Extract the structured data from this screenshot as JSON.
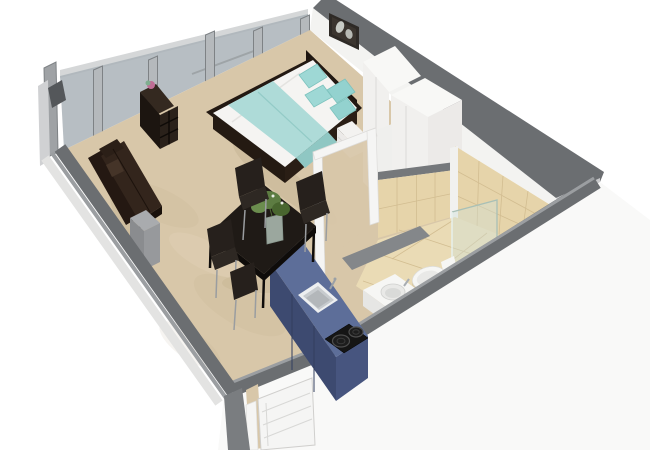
{
  "scene": {
    "type": "3d-floorplan-rendering",
    "room": "studio-apartment",
    "background": "#ffffff"
  },
  "colors": {
    "bg": "#ffffff",
    "carpet": "#d8c7a9",
    "carpetShade": "#bcab8c",
    "carpetLight": "#e6d8bd",
    "tileWall": "#e6d4aa",
    "tileFloor": "#eadbb5",
    "tileGrout": "#d2bd91",
    "glass": "#aab3b8",
    "pillar": "#b5b9bc",
    "pillarEdge": "#7e8285",
    "wallWhite": "#f3f3f1",
    "wallCap": "#6b6e71",
    "wallCapLight": "#9b9ea1",
    "wallOuterLight": "#c8c9cb",
    "outerFace": "#f9f9f8",
    "partitionCap": "#75787b",
    "halfWall": "#84878a",
    "bedFrame": "#231912",
    "headboard": "#1d1510",
    "mattress": "#f5f4f2",
    "blanket": "#aedbd8",
    "blanketFold": "#8fc7c3",
    "pillowA": "#9ed8d5",
    "pillowB": "#93d2cf",
    "wardrobeFront": "#f1f0ee",
    "wardrobeSide": "#eceae8",
    "wardrobeTop": "#f8f8f6",
    "nightstand": "#f3f2f0",
    "pictureFrame": "#2e2a26",
    "pictureArt": "#d8dcd6",
    "shelfDark": "#1c1510",
    "shelfSide": "#2a211a",
    "shelfTop": "#342920",
    "decorBall": "#c06d95",
    "decorLeaf": "#7fae8f",
    "sofa": "#241812",
    "sofaSeat": "#33251c",
    "pedestal": "#a9abae",
    "pedestalFront": "#8a8c8f",
    "tableTop": "#1f1a16",
    "tableEdge": "#0f0c0a",
    "chair": "#26201c",
    "chairSeat": "#2e2823",
    "metalLeg": "#9a9da0",
    "plantGreen": "#5d7c42",
    "plantDark": "#49662f",
    "plantLight": "#6b8d4e",
    "vase": "#c5d6cc",
    "counterTop": "#5d6e99",
    "counterFront": "#3d4a70",
    "counterSide": "#47557f",
    "sinkRim": "#edeff0",
    "sinkBasin": "#c7cbce",
    "cooktop": "#151515",
    "burnerRing": "#4d4d4d",
    "porcelain": "#f6f6f4",
    "porcelainShade": "#e9e9e7",
    "showerGlass": "#cfe2da",
    "showerEdge": "#a9c0b6",
    "doorWhite": "#f5f5f4",
    "doorLine": "#d8d8d6",
    "tvPanel": "#54575a"
  },
  "items": [
    "window-wall",
    "left-wall",
    "right-wall",
    "entry-wall",
    "entry-door",
    "bathroom-door-frame",
    "bed",
    "headboard",
    "pillows",
    "blanket",
    "nightstand",
    "wardrobe",
    "wall-picture",
    "cube-shelf",
    "decor-ball",
    "sofa",
    "side-table",
    "dining-table",
    "dining-chairs",
    "plant",
    "kitchen-counter",
    "kitchen-sink",
    "cooktop",
    "shower-glass",
    "toilet",
    "sink-vanity",
    "tiled-walls",
    "carpet-floor",
    "tile-floor"
  ]
}
